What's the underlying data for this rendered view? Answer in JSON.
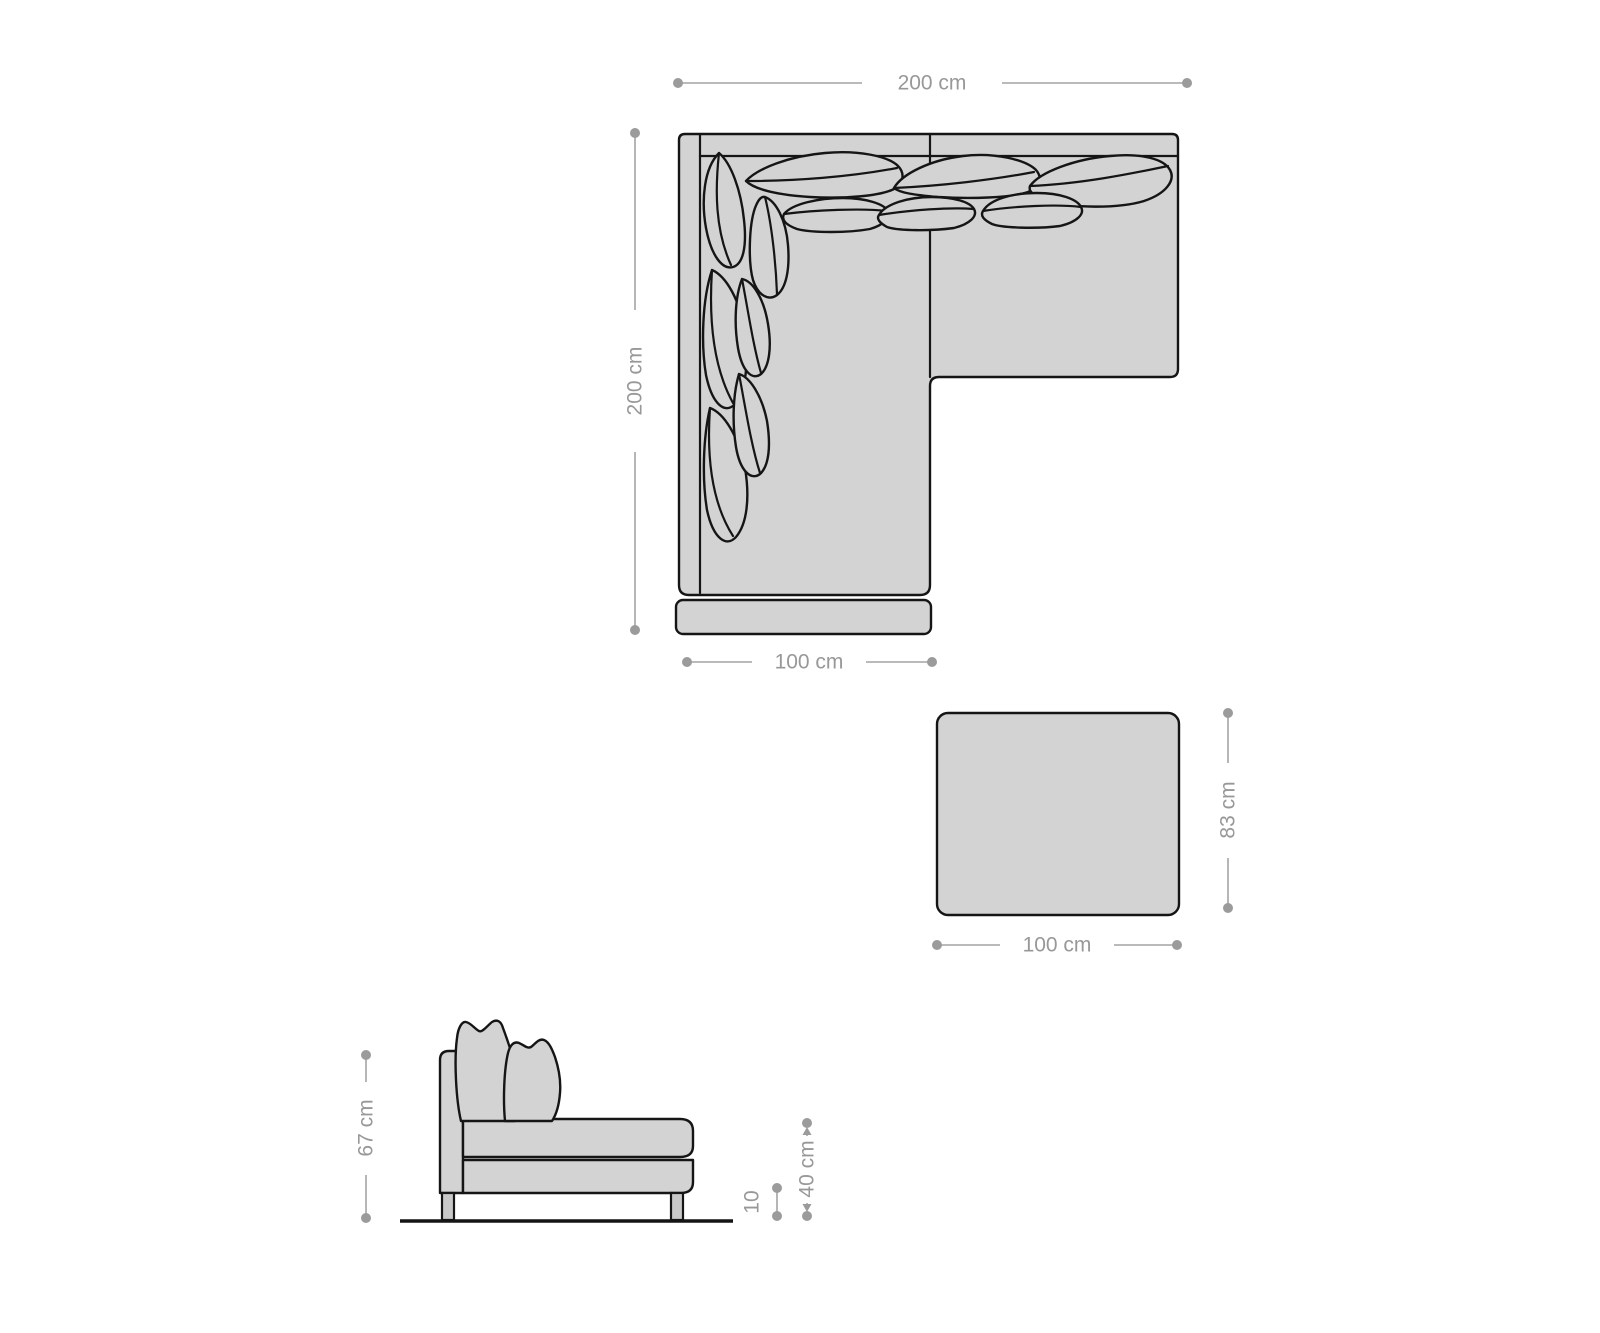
{
  "page": {
    "description": "Furniture dimension diagram: corner sofa (top view), ottoman (top view) and sofa side view with measurements"
  },
  "colors": {
    "background": "#ffffff",
    "upholstery_fill": "#d3d3d3",
    "leg_fill": "#c8c8c8",
    "outline": "#151515",
    "dimension_line": "#a3a3a3",
    "dimension_text": "#989898"
  },
  "labels": {
    "sofa_width": "200 cm",
    "sofa_depth": "200 cm",
    "chaise_width": "100 cm",
    "ottoman_width": "100 cm",
    "ottoman_depth": "83 cm",
    "sofa_height": "67 cm",
    "seat_height": "40 cm",
    "leg_height": "10"
  }
}
